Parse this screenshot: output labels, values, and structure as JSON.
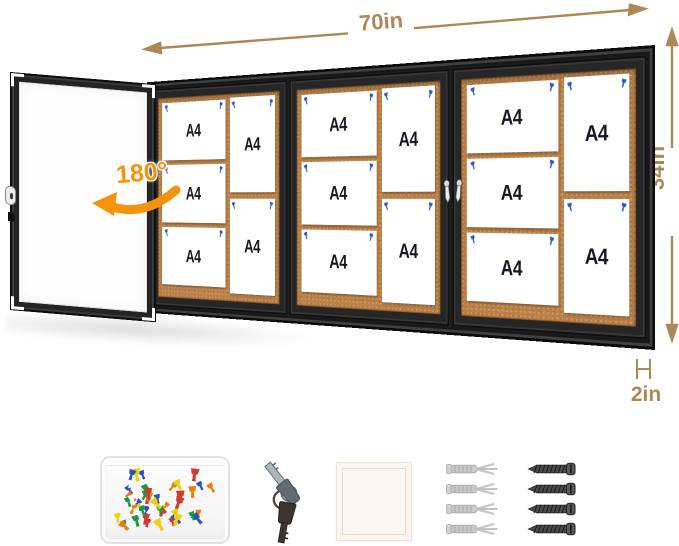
{
  "product": {
    "title": "enclosed bulletin board with dimension annotations",
    "dimensions": {
      "width": "70in",
      "height": "34in",
      "depth": "2in",
      "door_swing": "180°"
    },
    "colors": {
      "dimension_annotation": "#ad8757",
      "swing_annotation": "#f6920e",
      "frame": "#262626",
      "cork": "#bc8147",
      "push_pin": "#2b5ec6",
      "paper": "#ffffff",
      "paper_text": "#171722"
    }
  },
  "board": {
    "paper_label": "A4",
    "doors": [
      {
        "id": "door-1",
        "left_papers": [
          "A4",
          "A4",
          "A4"
        ],
        "right_papers": [
          "A4",
          "A4"
        ]
      },
      {
        "id": "door-2",
        "left_papers": [
          "A4",
          "A4",
          "A4"
        ],
        "right_papers": [
          "A4",
          "A4"
        ]
      },
      {
        "id": "door-3",
        "left_papers": [
          "A4",
          "A4",
          "A4"
        ],
        "right_papers": [
          "A4",
          "A4"
        ]
      }
    ]
  },
  "accessories": {
    "pushpin_box": {
      "pin_count": 54,
      "pin_colors": [
        "#d23b2c",
        "#2b50c0",
        "#159a48",
        "#f2cf0c",
        "#ffffff",
        "#e97e12"
      ]
    },
    "keys_count": 2,
    "wall_anchors_count": 4,
    "screws_count": 4
  }
}
